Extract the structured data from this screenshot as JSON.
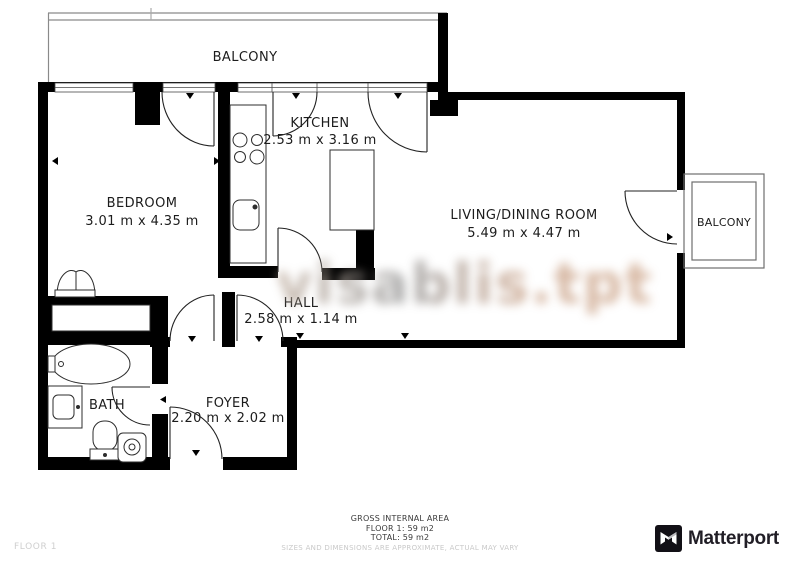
{
  "plan": {
    "rooms": {
      "balcony_top": {
        "name": "BALCONY"
      },
      "bedroom": {
        "name": "BEDROOM",
        "dims": "3.01 m x 4.35 m"
      },
      "kitchen": {
        "name": "KITCHEN",
        "dims": "2.53 m x 3.16 m"
      },
      "living": {
        "name": "LIVING/DINING ROOM",
        "dims": "5.49 m x 4.47 m"
      },
      "balcony_right": {
        "name": "BALCONY"
      },
      "hall": {
        "name": "HALL",
        "dims": "2.58 m x 1.14 m"
      },
      "foyer": {
        "name": "FOYER",
        "dims": "2.20 m x 2.02 m"
      },
      "bath": {
        "name": "BATH"
      }
    }
  },
  "watermark": {
    "text": "visablis.tpt"
  },
  "footer": {
    "area_title": "GROSS INTERNAL AREA",
    "floor_line": "FLOOR 1: 59 m2",
    "total_line": "TOTAL: 59 m2",
    "disclaimer": "SIZES AND DIMENSIONS ARE APPROXIMATE, ACTUAL MAY VARY",
    "floor_label": "FLOOR 1"
  },
  "brand": {
    "name": "Matterport"
  },
  "colors": {
    "wall": "#000000",
    "background": "#ffffff",
    "watermark_tan": "#c59a7e",
    "watermark_gray": "#8d8d8d",
    "disclaimer_gray": "#c9c9c9",
    "floor_label_gray": "#cfcfcf",
    "brand_text": "#211e26"
  }
}
